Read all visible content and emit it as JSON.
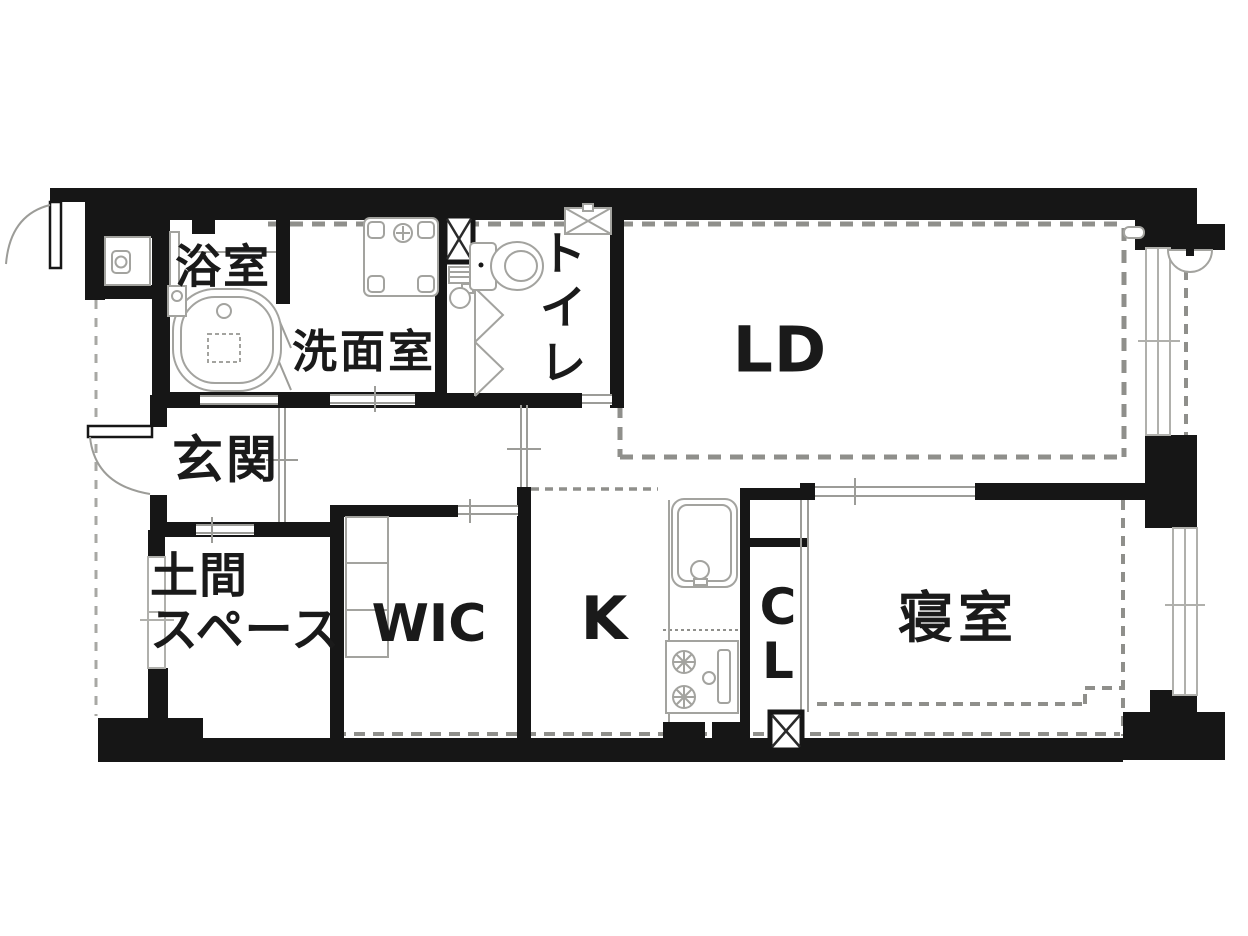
{
  "floorplan": {
    "rooms": {
      "bathroom": {
        "label": "浴室"
      },
      "washroom": {
        "label": "洗面室"
      },
      "toilet": {
        "label": "ト\nイ\nレ"
      },
      "living_dining": {
        "label": "LD"
      },
      "entrance": {
        "label": "玄関"
      },
      "doma_space": {
        "label": "土間\nスペース"
      },
      "wic": {
        "label": "WIC"
      },
      "kitchen": {
        "label": "K"
      },
      "closet": {
        "label": "C\nL"
      },
      "bedroom": {
        "label": "寝室"
      }
    },
    "colors": {
      "wall": "#161616",
      "fixture": "#a3a39f",
      "dash": "#8f8f8b",
      "text": "#1a1a1a",
      "background": "#ffffff"
    },
    "fixtures": [
      "bathtub",
      "washing-machine-pan",
      "toilet-bowl",
      "hand-basin",
      "corner-sink",
      "pipe-space",
      "kitchen-sink",
      "gas-stove",
      "meter-box",
      "entrance-door",
      "porch-door",
      "storage-shelves"
    ]
  }
}
